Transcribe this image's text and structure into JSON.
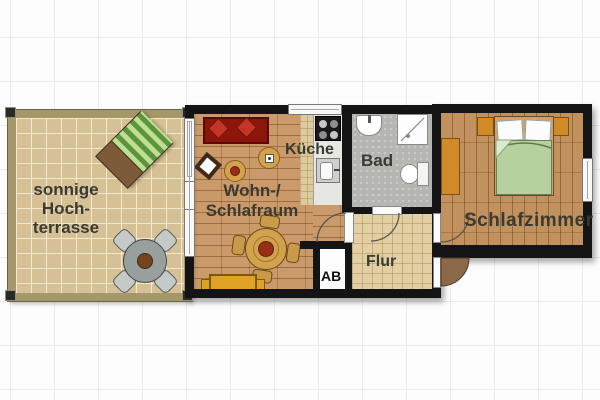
{
  "rooms": {
    "terrace": {
      "label_lines": [
        "sonnige",
        "Hoch-",
        "terrasse"
      ]
    },
    "living": {
      "label_lines": [
        "Wohn-/",
        "Schlafraum"
      ]
    },
    "kitchen": {
      "label": "Küche"
    },
    "bath": {
      "label": "Bad"
    },
    "hall": {
      "label": "Flur"
    },
    "storage": {
      "label": "AB"
    },
    "bedroom": {
      "label": "Schlafzimmer"
    }
  },
  "icons": {
    "terrace": [
      "sun-lounger-icon",
      "outdoor-table-set-icon"
    ],
    "living": [
      "sofa-icon",
      "side-table-icon",
      "plant-table-icon",
      "dining-table-set-icon",
      "sideboard-icon"
    ],
    "kitchen": [
      "stove-icon",
      "sink-icon",
      "counter-icon"
    ],
    "bath": [
      "washbasin-icon",
      "shower-icon",
      "toilet-icon"
    ],
    "bedroom": [
      "double-bed-icon",
      "nightstand-icon",
      "wardrobe-icon"
    ],
    "doors": [
      "door-swing-arc",
      "entrance-door-swing"
    ]
  },
  "colors": {
    "wall": "#141414",
    "wood_living": "#c6925e",
    "wood_bedroom": "#bc8852",
    "tile_terrace": "#d6c196",
    "tile_hall": "#e2cfa4",
    "bath_floor": "#b5b5b2",
    "sofa_red": "#8e150c",
    "cushion_red": "#c23527",
    "duvet_green": "#b7d0a0",
    "furniture_orange": "#d08a28",
    "bench_yellow": "#e0a224",
    "lounger_green": "#6fa04a",
    "entry_door_wood": "#8a6848",
    "label_text": "#3a3a31"
  }
}
